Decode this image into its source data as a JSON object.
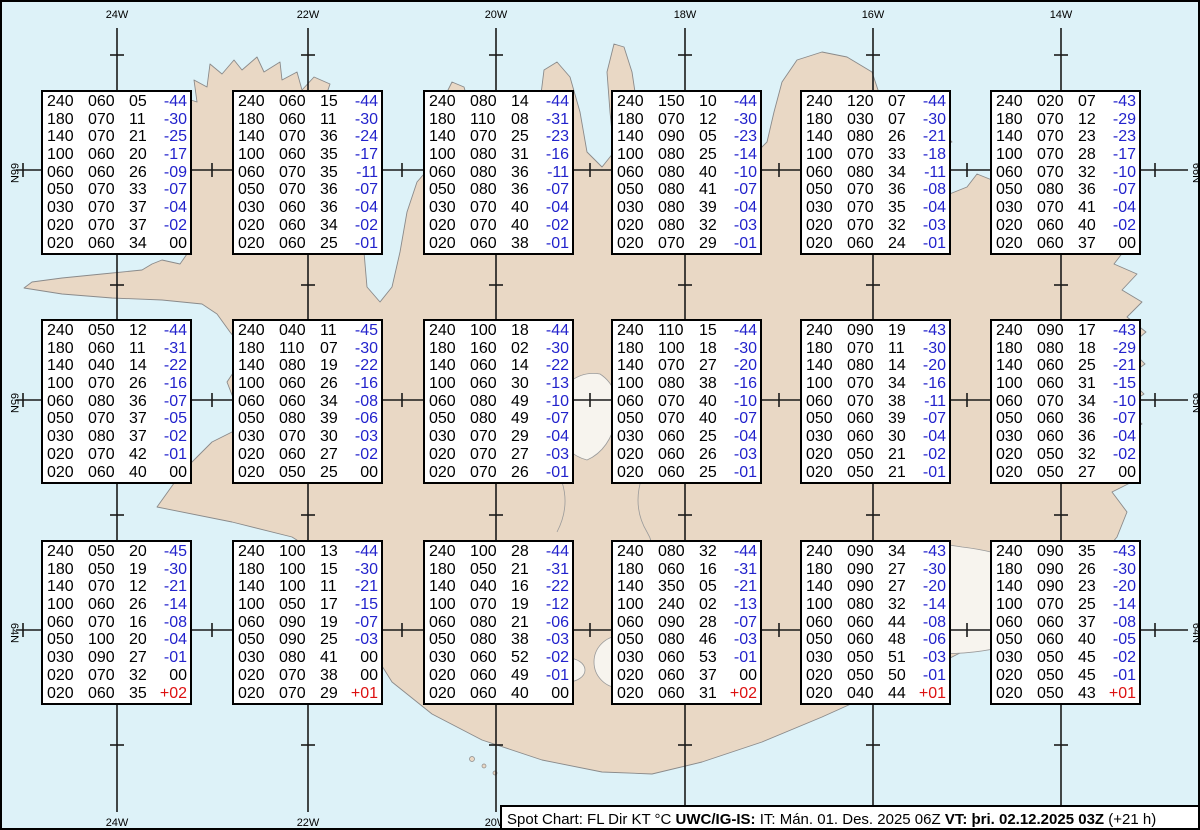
{
  "colors": {
    "sea": "#ddf2f8",
    "land": "#e9d8c5",
    "coastline": "#8a8a8a",
    "grid": "#1a1a1a",
    "negative": "#2222cc",
    "positive": "#dd1111",
    "text": "#000000",
    "box_background": "#ffffff"
  },
  "map_labels": {
    "top_meridians": [
      "24W",
      "22W",
      "20W",
      "18W",
      "16W",
      "14W"
    ],
    "bottom_meridians": [
      "24W",
      "22W",
      "20W"
    ],
    "left_parallels": [
      "66N",
      "65N",
      "64N"
    ],
    "right_parallels": [
      "66N",
      "65N",
      "64N"
    ]
  },
  "status_bar": {
    "segments": [
      {
        "text": "Spot Chart: FL Dir KT °C ",
        "bold": false
      },
      {
        "text": "UWC/IG-IS:",
        "bold": true
      },
      {
        "text": " IT: Mán. 01. Des. 2025 06Z ",
        "bold": false
      },
      {
        "text": "VT: þri. 02.12.2025 03Z",
        "bold": true
      },
      {
        "text": " (+21 h)",
        "bold": false
      }
    ]
  },
  "stations": [
    {
      "rows": [
        [
          "240",
          "060",
          "05",
          "-44"
        ],
        [
          "180",
          "070",
          "11",
          "-30"
        ],
        [
          "140",
          "070",
          "21",
          "-25"
        ],
        [
          "100",
          "060",
          "20",
          "-17"
        ],
        [
          "060",
          "060",
          "26",
          "-09"
        ],
        [
          "050",
          "070",
          "33",
          "-07"
        ],
        [
          "030",
          "070",
          "37",
          "-04"
        ],
        [
          "020",
          "070",
          "37",
          "-02"
        ],
        [
          "020",
          "060",
          "34",
          "00"
        ]
      ]
    },
    {
      "rows": [
        [
          "240",
          "060",
          "15",
          "-44"
        ],
        [
          "180",
          "060",
          "11",
          "-30"
        ],
        [
          "140",
          "070",
          "36",
          "-24"
        ],
        [
          "100",
          "060",
          "35",
          "-17"
        ],
        [
          "060",
          "070",
          "35",
          "-11"
        ],
        [
          "050",
          "070",
          "36",
          "-07"
        ],
        [
          "030",
          "060",
          "36",
          "-04"
        ],
        [
          "020",
          "060",
          "34",
          "-02"
        ],
        [
          "020",
          "060",
          "25",
          "-01"
        ]
      ]
    },
    {
      "rows": [
        [
          "240",
          "080",
          "14",
          "-44"
        ],
        [
          "180",
          "110",
          "08",
          "-31"
        ],
        [
          "140",
          "070",
          "25",
          "-23"
        ],
        [
          "100",
          "080",
          "31",
          "-16"
        ],
        [
          "060",
          "080",
          "36",
          "-11"
        ],
        [
          "050",
          "080",
          "36",
          "-07"
        ],
        [
          "030",
          "070",
          "40",
          "-04"
        ],
        [
          "020",
          "070",
          "40",
          "-02"
        ],
        [
          "020",
          "060",
          "38",
          "-01"
        ]
      ]
    },
    {
      "rows": [
        [
          "240",
          "150",
          "10",
          "-44"
        ],
        [
          "180",
          "070",
          "12",
          "-30"
        ],
        [
          "140",
          "090",
          "05",
          "-23"
        ],
        [
          "100",
          "080",
          "25",
          "-14"
        ],
        [
          "060",
          "080",
          "40",
          "-10"
        ],
        [
          "050",
          "080",
          "41",
          "-07"
        ],
        [
          "030",
          "080",
          "39",
          "-04"
        ],
        [
          "020",
          "080",
          "32",
          "-03"
        ],
        [
          "020",
          "070",
          "29",
          "-01"
        ]
      ]
    },
    {
      "rows": [
        [
          "240",
          "120",
          "07",
          "-44"
        ],
        [
          "180",
          "030",
          "07",
          "-30"
        ],
        [
          "140",
          "080",
          "26",
          "-21"
        ],
        [
          "100",
          "070",
          "33",
          "-18"
        ],
        [
          "060",
          "080",
          "34",
          "-11"
        ],
        [
          "050",
          "070",
          "36",
          "-08"
        ],
        [
          "030",
          "070",
          "35",
          "-04"
        ],
        [
          "020",
          "070",
          "32",
          "-03"
        ],
        [
          "020",
          "060",
          "24",
          "-01"
        ]
      ]
    },
    {
      "rows": [
        [
          "240",
          "020",
          "07",
          "-43"
        ],
        [
          "180",
          "070",
          "12",
          "-29"
        ],
        [
          "140",
          "070",
          "23",
          "-23"
        ],
        [
          "100",
          "070",
          "28",
          "-17"
        ],
        [
          "060",
          "070",
          "32",
          "-10"
        ],
        [
          "050",
          "080",
          "36",
          "-07"
        ],
        [
          "030",
          "070",
          "41",
          "-04"
        ],
        [
          "020",
          "060",
          "40",
          "-02"
        ],
        [
          "020",
          "060",
          "37",
          "00"
        ]
      ]
    },
    {
      "rows": [
        [
          "240",
          "050",
          "12",
          "-44"
        ],
        [
          "180",
          "060",
          "11",
          "-31"
        ],
        [
          "140",
          "040",
          "14",
          "-22"
        ],
        [
          "100",
          "070",
          "26",
          "-16"
        ],
        [
          "060",
          "080",
          "36",
          "-07"
        ],
        [
          "050",
          "070",
          "37",
          "-05"
        ],
        [
          "030",
          "080",
          "37",
          "-02"
        ],
        [
          "020",
          "070",
          "42",
          "-01"
        ],
        [
          "020",
          "060",
          "40",
          "00"
        ]
      ]
    },
    {
      "rows": [
        [
          "240",
          "040",
          "11",
          "-45"
        ],
        [
          "180",
          "110",
          "07",
          "-30"
        ],
        [
          "140",
          "080",
          "19",
          "-22"
        ],
        [
          "100",
          "060",
          "26",
          "-16"
        ],
        [
          "060",
          "060",
          "34",
          "-08"
        ],
        [
          "050",
          "080",
          "39",
          "-06"
        ],
        [
          "030",
          "070",
          "30",
          "-03"
        ],
        [
          "020",
          "060",
          "27",
          "-02"
        ],
        [
          "020",
          "050",
          "25",
          "00"
        ]
      ]
    },
    {
      "rows": [
        [
          "240",
          "100",
          "18",
          "-44"
        ],
        [
          "180",
          "160",
          "02",
          "-30"
        ],
        [
          "140",
          "060",
          "14",
          "-22"
        ],
        [
          "100",
          "060",
          "30",
          "-13"
        ],
        [
          "060",
          "080",
          "49",
          "-10"
        ],
        [
          "050",
          "080",
          "49",
          "-07"
        ],
        [
          "030",
          "070",
          "29",
          "-04"
        ],
        [
          "020",
          "070",
          "27",
          "-03"
        ],
        [
          "020",
          "070",
          "26",
          "-01"
        ]
      ]
    },
    {
      "rows": [
        [
          "240",
          "110",
          "15",
          "-44"
        ],
        [
          "180",
          "100",
          "18",
          "-30"
        ],
        [
          "140",
          "070",
          "27",
          "-20"
        ],
        [
          "100",
          "080",
          "38",
          "-16"
        ],
        [
          "060",
          "070",
          "40",
          "-10"
        ],
        [
          "050",
          "070",
          "40",
          "-07"
        ],
        [
          "030",
          "060",
          "25",
          "-04"
        ],
        [
          "020",
          "060",
          "26",
          "-03"
        ],
        [
          "020",
          "060",
          "25",
          "-01"
        ]
      ]
    },
    {
      "rows": [
        [
          "240",
          "090",
          "19",
          "-43"
        ],
        [
          "180",
          "070",
          "11",
          "-30"
        ],
        [
          "140",
          "080",
          "14",
          "-20"
        ],
        [
          "100",
          "070",
          "34",
          "-16"
        ],
        [
          "060",
          "070",
          "38",
          "-11"
        ],
        [
          "050",
          "060",
          "39",
          "-07"
        ],
        [
          "030",
          "060",
          "30",
          "-04"
        ],
        [
          "020",
          "050",
          "21",
          "-02"
        ],
        [
          "020",
          "050",
          "21",
          "-01"
        ]
      ]
    },
    {
      "rows": [
        [
          "240",
          "090",
          "17",
          "-43"
        ],
        [
          "180",
          "080",
          "18",
          "-29"
        ],
        [
          "140",
          "060",
          "25",
          "-21"
        ],
        [
          "100",
          "060",
          "31",
          "-15"
        ],
        [
          "060",
          "070",
          "34",
          "-10"
        ],
        [
          "050",
          "060",
          "36",
          "-07"
        ],
        [
          "030",
          "060",
          "36",
          "-04"
        ],
        [
          "020",
          "050",
          "32",
          "-02"
        ],
        [
          "020",
          "050",
          "27",
          "00"
        ]
      ]
    },
    {
      "rows": [
        [
          "240",
          "050",
          "20",
          "-45"
        ],
        [
          "180",
          "050",
          "19",
          "-30"
        ],
        [
          "140",
          "070",
          "12",
          "-21"
        ],
        [
          "100",
          "060",
          "26",
          "-14"
        ],
        [
          "060",
          "070",
          "16",
          "-08"
        ],
        [
          "050",
          "100",
          "20",
          "-04"
        ],
        [
          "030",
          "090",
          "27",
          "-01"
        ],
        [
          "020",
          "070",
          "32",
          "00"
        ],
        [
          "020",
          "060",
          "35",
          "+02"
        ]
      ]
    },
    {
      "rows": [
        [
          "240",
          "100",
          "13",
          "-44"
        ],
        [
          "180",
          "100",
          "15",
          "-30"
        ],
        [
          "140",
          "100",
          "11",
          "-21"
        ],
        [
          "100",
          "050",
          "17",
          "-15"
        ],
        [
          "060",
          "090",
          "19",
          "-07"
        ],
        [
          "050",
          "090",
          "25",
          "-03"
        ],
        [
          "030",
          "080",
          "41",
          "00"
        ],
        [
          "020",
          "070",
          "38",
          "00"
        ],
        [
          "020",
          "070",
          "29",
          "+01"
        ]
      ]
    },
    {
      "rows": [
        [
          "240",
          "100",
          "28",
          "-44"
        ],
        [
          "180",
          "050",
          "21",
          "-31"
        ],
        [
          "140",
          "040",
          "16",
          "-22"
        ],
        [
          "100",
          "070",
          "19",
          "-12"
        ],
        [
          "060",
          "080",
          "21",
          "-06"
        ],
        [
          "050",
          "080",
          "38",
          "-03"
        ],
        [
          "030",
          "060",
          "52",
          "-02"
        ],
        [
          "020",
          "060",
          "49",
          "-01"
        ],
        [
          "020",
          "060",
          "40",
          "00"
        ]
      ]
    },
    {
      "rows": [
        [
          "240",
          "080",
          "32",
          "-44"
        ],
        [
          "180",
          "060",
          "16",
          "-31"
        ],
        [
          "140",
          "350",
          "05",
          "-21"
        ],
        [
          "100",
          "240",
          "02",
          "-13"
        ],
        [
          "060",
          "090",
          "28",
          "-07"
        ],
        [
          "050",
          "080",
          "46",
          "-03"
        ],
        [
          "030",
          "060",
          "53",
          "-01"
        ],
        [
          "020",
          "060",
          "37",
          "00"
        ],
        [
          "020",
          "060",
          "31",
          "+02"
        ]
      ]
    },
    {
      "rows": [
        [
          "240",
          "090",
          "34",
          "-43"
        ],
        [
          "180",
          "090",
          "27",
          "-30"
        ],
        [
          "140",
          "090",
          "27",
          "-20"
        ],
        [
          "100",
          "080",
          "32",
          "-14"
        ],
        [
          "060",
          "060",
          "44",
          "-08"
        ],
        [
          "050",
          "060",
          "48",
          "-06"
        ],
        [
          "030",
          "050",
          "51",
          "-03"
        ],
        [
          "020",
          "050",
          "50",
          "-01"
        ],
        [
          "020",
          "040",
          "44",
          "+01"
        ]
      ]
    },
    {
      "rows": [
        [
          "240",
          "090",
          "35",
          "-43"
        ],
        [
          "180",
          "090",
          "26",
          "-30"
        ],
        [
          "140",
          "090",
          "23",
          "-20"
        ],
        [
          "100",
          "070",
          "25",
          "-14"
        ],
        [
          "060",
          "060",
          "37",
          "-08"
        ],
        [
          "050",
          "060",
          "40",
          "-05"
        ],
        [
          "030",
          "050",
          "45",
          "-02"
        ],
        [
          "020",
          "050",
          "45",
          "-01"
        ],
        [
          "020",
          "050",
          "43",
          "+01"
        ]
      ]
    }
  ]
}
